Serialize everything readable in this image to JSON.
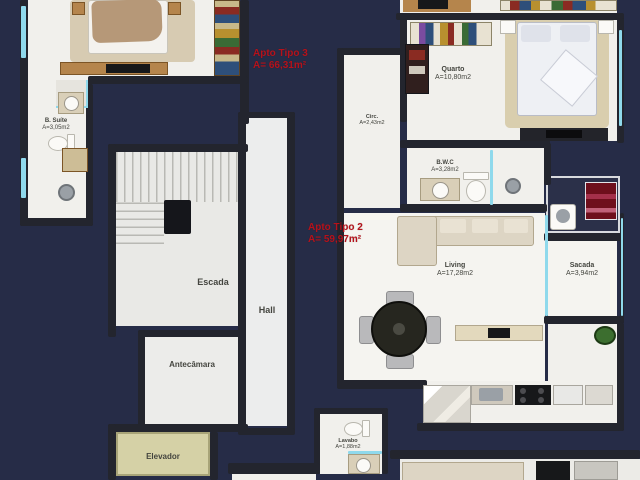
{
  "plan_title": "Apartment floor plan",
  "colors": {
    "background": "#262c47",
    "wall": "#23252e",
    "floor": "#f1f0ec",
    "elevator_floor": "#d5d1a6",
    "glass": "#8fd9ec",
    "apartment_label": "#b5121b",
    "room_label": "#44453f",
    "wood": "#b5854c",
    "rug": "#d7cbb2"
  },
  "apartments": [
    {
      "id": "tipo3",
      "line1": "Apto Tipo 3",
      "line2": "A= 66,31m²"
    },
    {
      "id": "tipo2",
      "line1": "Apto Tipo 2",
      "line2": "A= 59,97m²"
    }
  ],
  "rooms": [
    {
      "id": "b-suite",
      "name": "B. Suíte",
      "area": "A=3,05m2"
    },
    {
      "id": "escada",
      "name": "Escada",
      "area": ""
    },
    {
      "id": "hall",
      "name": "Hall",
      "area": ""
    },
    {
      "id": "antecamara",
      "name": "Antecâmara",
      "area": ""
    },
    {
      "id": "elevador",
      "name": "Elevador",
      "area": ""
    },
    {
      "id": "circ",
      "name": "Circ.",
      "area": "A=2,43m2"
    },
    {
      "id": "quarto",
      "name": "Quarto",
      "area": "A=10,80m2"
    },
    {
      "id": "bwc",
      "name": "B.W.C",
      "area": "A=3,28m2"
    },
    {
      "id": "living",
      "name": "Living",
      "area": "A=17,28m2"
    },
    {
      "id": "sacada",
      "name": "Sacada",
      "area": "A=3,94m2"
    },
    {
      "id": "lavabo",
      "name": "Lavabo",
      "area": "A=1,88m2"
    }
  ]
}
